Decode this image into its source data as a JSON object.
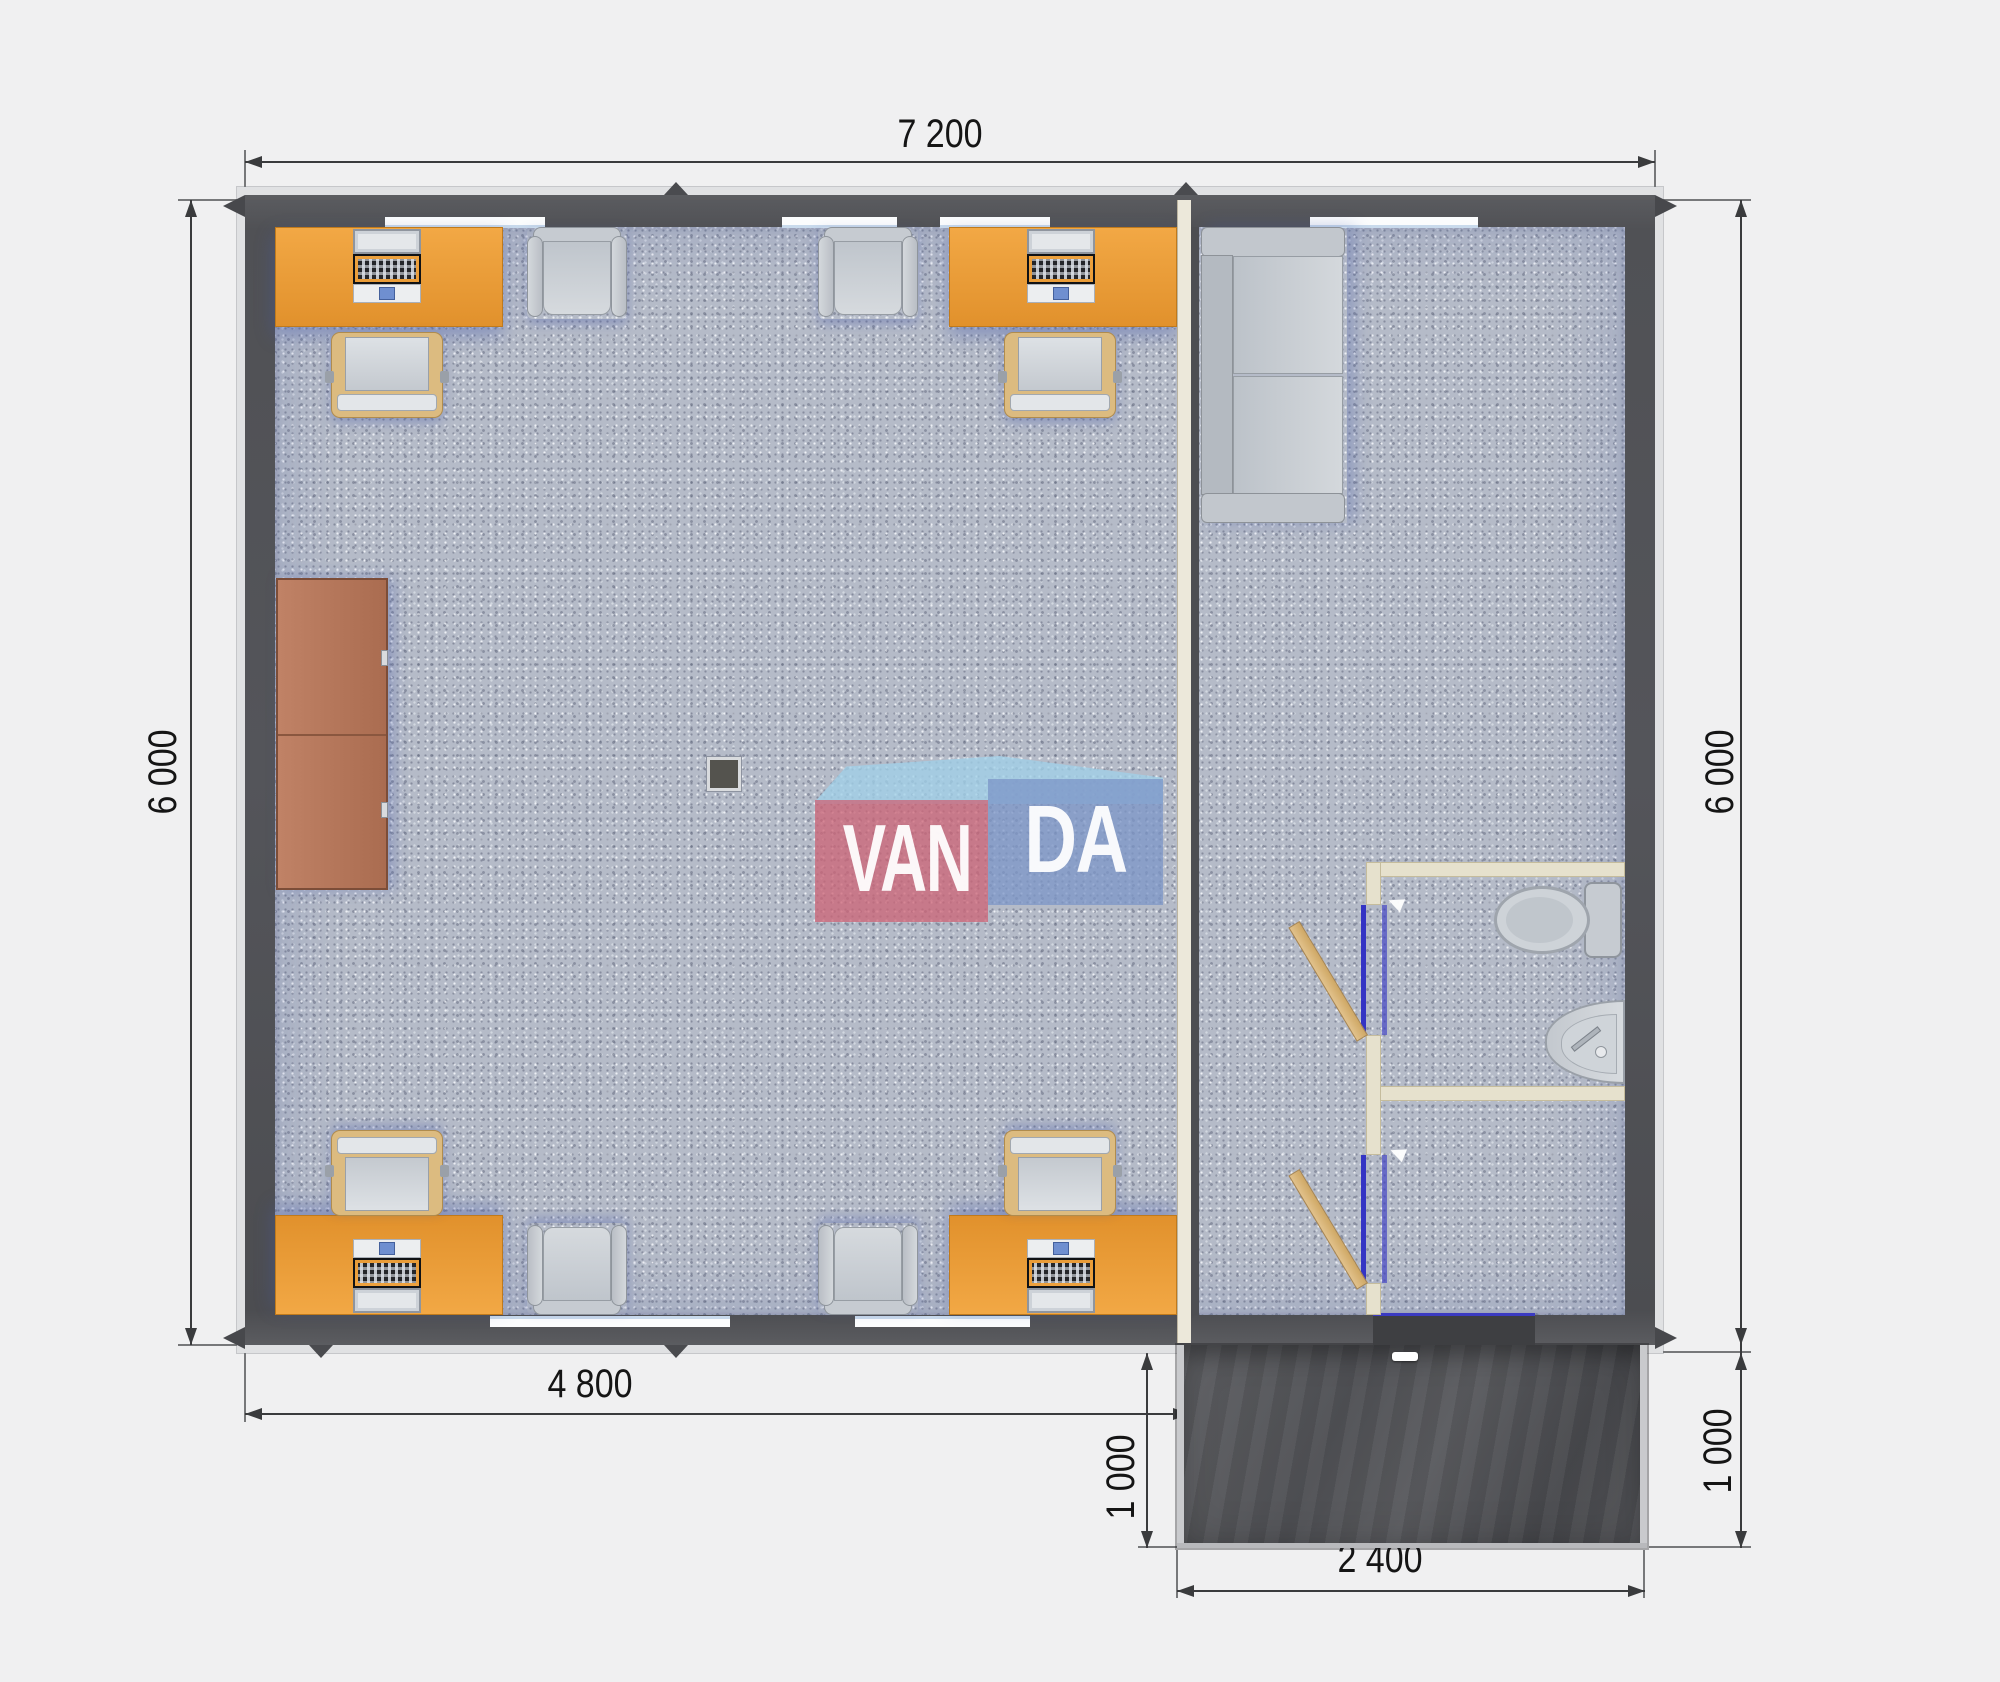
{
  "watermark": {
    "left_text": "VAN",
    "right_text": "DA"
  },
  "dimensions": {
    "overall_width_mm": "7 200",
    "left_height_mm": "6 000",
    "right_height_mm": "6 000",
    "office_width_mm": "4 800",
    "porch_depth_left_mm": "1 000",
    "porch_width_mm": "2 400",
    "porch_depth_right_mm": "1 000"
  },
  "palette": {
    "background": "#f0f0f1",
    "wall_dark": "#54555a",
    "carpet": "#b5bbc8",
    "desk_orange": "#eca03b",
    "cabinet_brown": "#b57a5f",
    "partition_cream": "#ece8da",
    "bath_wall_cream": "#e6e1cd",
    "door_wood": "#d8b57e",
    "door_frame_blue": "#3434c4",
    "porch_dark": "#515256",
    "furniture_gray": "#c6cbd1",
    "watermark_red": "#cd6476",
    "watermark_blue": "#7d96c8",
    "watermark_sky": "#a0d0e8",
    "dimension_line": "#3a3b3d"
  },
  "furniture_legend": {
    "desk": "orange-rect",
    "computer": "monitor-keyboard-top-view",
    "office_chair": "tan-frame-gray-seat",
    "guest_chair": "gray-armchair",
    "sofa": "two-seat-gray",
    "cabinet": "brown-wardrobe",
    "toilet": "tank-and-bowl",
    "sink": "corner-half-round",
    "door": "wood-leaf-open-31deg",
    "column": "dark-square",
    "porch": "dark-deck"
  }
}
